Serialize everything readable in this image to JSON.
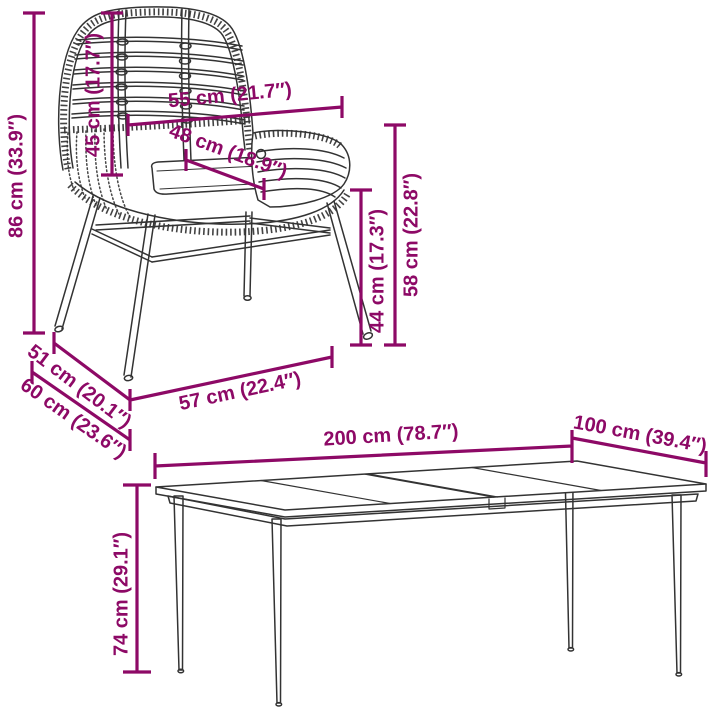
{
  "page": {
    "background": "#ffffff",
    "accent_color": "#8D0966",
    "line_color": "#333333"
  },
  "chair": {
    "dims": {
      "total_height": {
        "label": "86 cm (33.9″)",
        "cm": 86,
        "in": 33.9
      },
      "backrest_height": {
        "label": "45 cm (17.7″)",
        "cm": 45,
        "in": 17.7
      },
      "backrest_width": {
        "label": "55 cm (21.7″)",
        "cm": 55,
        "in": 21.7
      },
      "seat_depth": {
        "label": "48 cm (18.9″)",
        "cm": 48,
        "in": 18.9
      },
      "seat_height": {
        "label": "44 cm (17.3″)",
        "cm": 44,
        "in": 17.3
      },
      "armrest_height": {
        "label": "58 cm (22.8″)",
        "cm": 58,
        "in": 22.8
      },
      "seat_width": {
        "label": "51 cm (20.1″)",
        "cm": 51,
        "in": 20.1
      },
      "depth": {
        "label": "60 cm (23.6″)",
        "cm": 60,
        "in": 23.6
      },
      "width": {
        "label": "57 cm (22.4″)",
        "cm": 57,
        "in": 22.4
      }
    }
  },
  "table": {
    "dims": {
      "length": {
        "label": "200 cm (78.7″)",
        "cm": 200,
        "in": 78.7
      },
      "width": {
        "label": "100 cm (39.4″)",
        "cm": 100,
        "in": 39.4
      },
      "height": {
        "label": "74 cm (29.1″)",
        "cm": 74,
        "in": 29.1
      }
    }
  }
}
